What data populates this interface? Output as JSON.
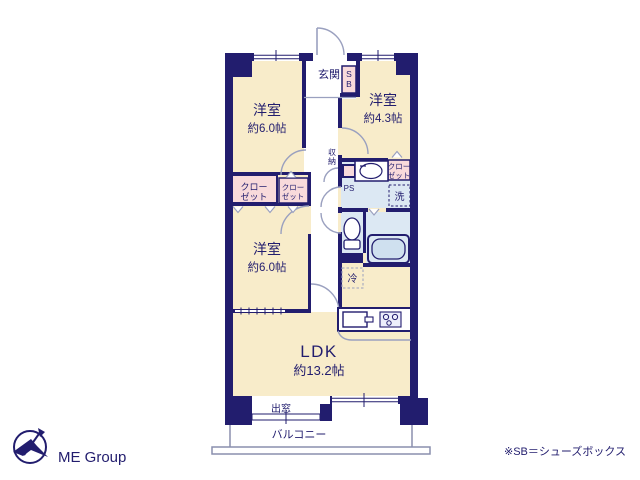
{
  "colors": {
    "wall_navy": "#221d6e",
    "room_cream": "#f8ecca",
    "closet_pink": "#f8dadb",
    "wet_blue": "#dce8f3",
    "door_arc_gray": "#9aa0bf",
    "logo_text_gray": "#cbcbcb"
  },
  "plan": {
    "entrance": {
      "label": "玄関"
    },
    "shoes_box": {
      "char1": "S",
      "char2": "B"
    },
    "room_top_left": {
      "name": "洋室",
      "size": "約6.0帖"
    },
    "room_top_right": {
      "name": "洋室",
      "size": "約4.3帖"
    },
    "room_mid_left": {
      "name": "洋室",
      "size": "約6.0帖"
    },
    "ldk": {
      "name": "LDK",
      "size": "約13.2帖"
    },
    "closet_left_large": {
      "line1": "クロー",
      "line2": "ゼット"
    },
    "closet_left_small": {
      "line1": "クロー",
      "line2": "ゼット"
    },
    "closet_right": {
      "line1": "クロー",
      "line2": "ゼット"
    },
    "storage": {
      "char1": "収",
      "char2": "納"
    },
    "ps_top": {
      "label": "PS"
    },
    "ps_bottom": {
      "label": "PS"
    },
    "laundry": {
      "label": "洗"
    },
    "fridge": {
      "label": "冷"
    },
    "bay_window": {
      "label": "出窓"
    },
    "balcony": {
      "label": "バルコニー"
    }
  },
  "footer": {
    "note": "※SB＝シューズボックス",
    "logo_text": "ME Group"
  }
}
